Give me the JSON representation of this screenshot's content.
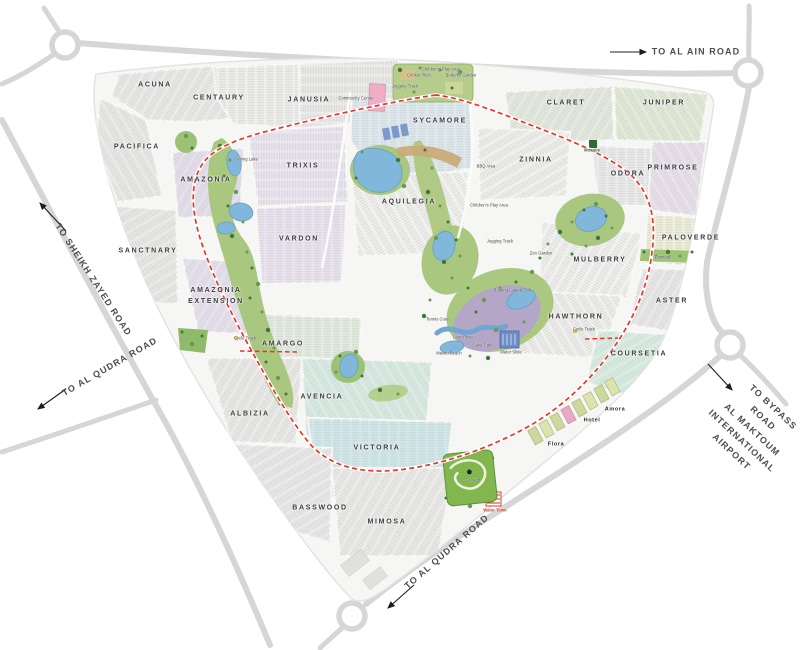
{
  "map": {
    "name": "community-masterplan-map",
    "colors": {
      "spine_road_red": "#e8362b",
      "highway_gray": "#d6d6d6",
      "park_green": "#a9c77f",
      "lake_blue": "#82b7dc",
      "label_dark": "#3b3b3b"
    },
    "road_labels": [
      {
        "label": "TO AL AIN ROAD",
        "x": 696,
        "y": 52,
        "rotate": 0
      },
      {
        "label": "TO SHEIKH ZAYED ROAD",
        "x": 93,
        "y": 280,
        "rotate": 57
      },
      {
        "label": "TO AL QUDRA ROAD",
        "x": 110,
        "y": 367,
        "rotate": -30
      },
      {
        "label": "TO AL QUDRA ROAD",
        "x": 447,
        "y": 552,
        "rotate": -41
      },
      {
        "label": "TO BYPASS ROAD\nAL MAKTOUM\nINTERNATIONAL AIRPORT",
        "x": 752,
        "y": 430,
        "rotate": 43
      }
    ],
    "clusters": [
      {
        "name": "ACUNA",
        "x": 155,
        "y": 86
      },
      {
        "name": "CENTAURY",
        "x": 219,
        "y": 99
      },
      {
        "name": "JANUSIA",
        "x": 309,
        "y": 101
      },
      {
        "name": "SYCAMORE",
        "x": 440,
        "y": 122
      },
      {
        "name": "CLARET",
        "x": 566,
        "y": 104
      },
      {
        "name": "JUNIPER",
        "x": 664,
        "y": 104
      },
      {
        "name": "PACIFICA",
        "x": 137,
        "y": 148
      },
      {
        "name": "TRIXIS",
        "x": 303,
        "y": 167
      },
      {
        "name": "ZINNIA",
        "x": 536,
        "y": 161
      },
      {
        "name": "ODORA",
        "x": 628,
        "y": 175
      },
      {
        "name": "PRIMROSE",
        "x": 673,
        "y": 169
      },
      {
        "name": "AMAZONIA",
        "x": 206,
        "y": 181
      },
      {
        "name": "AQUILEGIA",
        "x": 409,
        "y": 203
      },
      {
        "name": "VARDON",
        "x": 299,
        "y": 240
      },
      {
        "name": "MULBERRY",
        "x": 600,
        "y": 261
      },
      {
        "name": "PALOVERDE",
        "x": 691,
        "y": 239
      },
      {
        "name": "SANCTNARY",
        "x": 148,
        "y": 252
      },
      {
        "name": "AMAZONIA\nEXTENSION",
        "x": 216,
        "y": 297
      },
      {
        "name": "HAWTHORN",
        "x": 576,
        "y": 318
      },
      {
        "name": "ASTER",
        "x": 672,
        "y": 302
      },
      {
        "name": "AMARGO",
        "x": 283,
        "y": 345
      },
      {
        "name": "COURSETIA",
        "x": 639,
        "y": 355
      },
      {
        "name": "ALBIZIA",
        "x": 250,
        "y": 415
      },
      {
        "name": "AVENCIA",
        "x": 322,
        "y": 398
      },
      {
        "name": "VICTORIA",
        "x": 377,
        "y": 449
      },
      {
        "name": "BASSWOOD",
        "x": 320,
        "y": 509
      },
      {
        "name": "MIMOSA",
        "x": 387,
        "y": 523
      }
    ],
    "places": [
      {
        "name": "Flora",
        "x": 556,
        "y": 444
      },
      {
        "name": "Hotel",
        "x": 592,
        "y": 420
      },
      {
        "name": "Amora",
        "x": 615,
        "y": 409
      }
    ],
    "amenities": [
      {
        "label": "Community Centre",
        "x": 356,
        "y": 99
      },
      {
        "label": "Jogging Track",
        "x": 405,
        "y": 87
      },
      {
        "label": "Cricket Pitch",
        "x": 419,
        "y": 76
      },
      {
        "label": "Children's Play Area",
        "x": 441,
        "y": 70
      },
      {
        "label": "Butterfly Garden",
        "x": 461,
        "y": 76
      },
      {
        "label": "Fishing Lake",
        "x": 246,
        "y": 160
      },
      {
        "label": "BBQ Area",
        "x": 486,
        "y": 167
      },
      {
        "label": "Children's Play Area",
        "x": 489,
        "y": 206
      },
      {
        "label": "Jogging Track",
        "x": 500,
        "y": 242
      },
      {
        "label": "Zen Garden",
        "x": 541,
        "y": 254
      },
      {
        "label": "Boating Lake & Cafe",
        "x": 513,
        "y": 291
      },
      {
        "label": "Tennis Court",
        "x": 438,
        "y": 320
      },
      {
        "label": "Lazy River",
        "x": 463,
        "y": 338
      },
      {
        "label": "Lake Cafe",
        "x": 483,
        "y": 346
      },
      {
        "label": "Malibu Beach",
        "x": 449,
        "y": 354
      },
      {
        "label": "Water Slide",
        "x": 511,
        "y": 353
      },
      {
        "label": "Mosque",
        "x": 592,
        "y": 151,
        "color": "green"
      },
      {
        "label": "Paintball",
        "x": 663,
        "y": 258
      },
      {
        "label": "Cycle Track",
        "x": 584,
        "y": 330
      },
      {
        "label": "Cycle Track",
        "x": 245,
        "y": 339
      },
      {
        "label": "Go Kart",
        "x": 473,
        "y": 481
      },
      {
        "label": "Water Town",
        "x": 495,
        "y": 511,
        "color": "red"
      }
    ]
  }
}
